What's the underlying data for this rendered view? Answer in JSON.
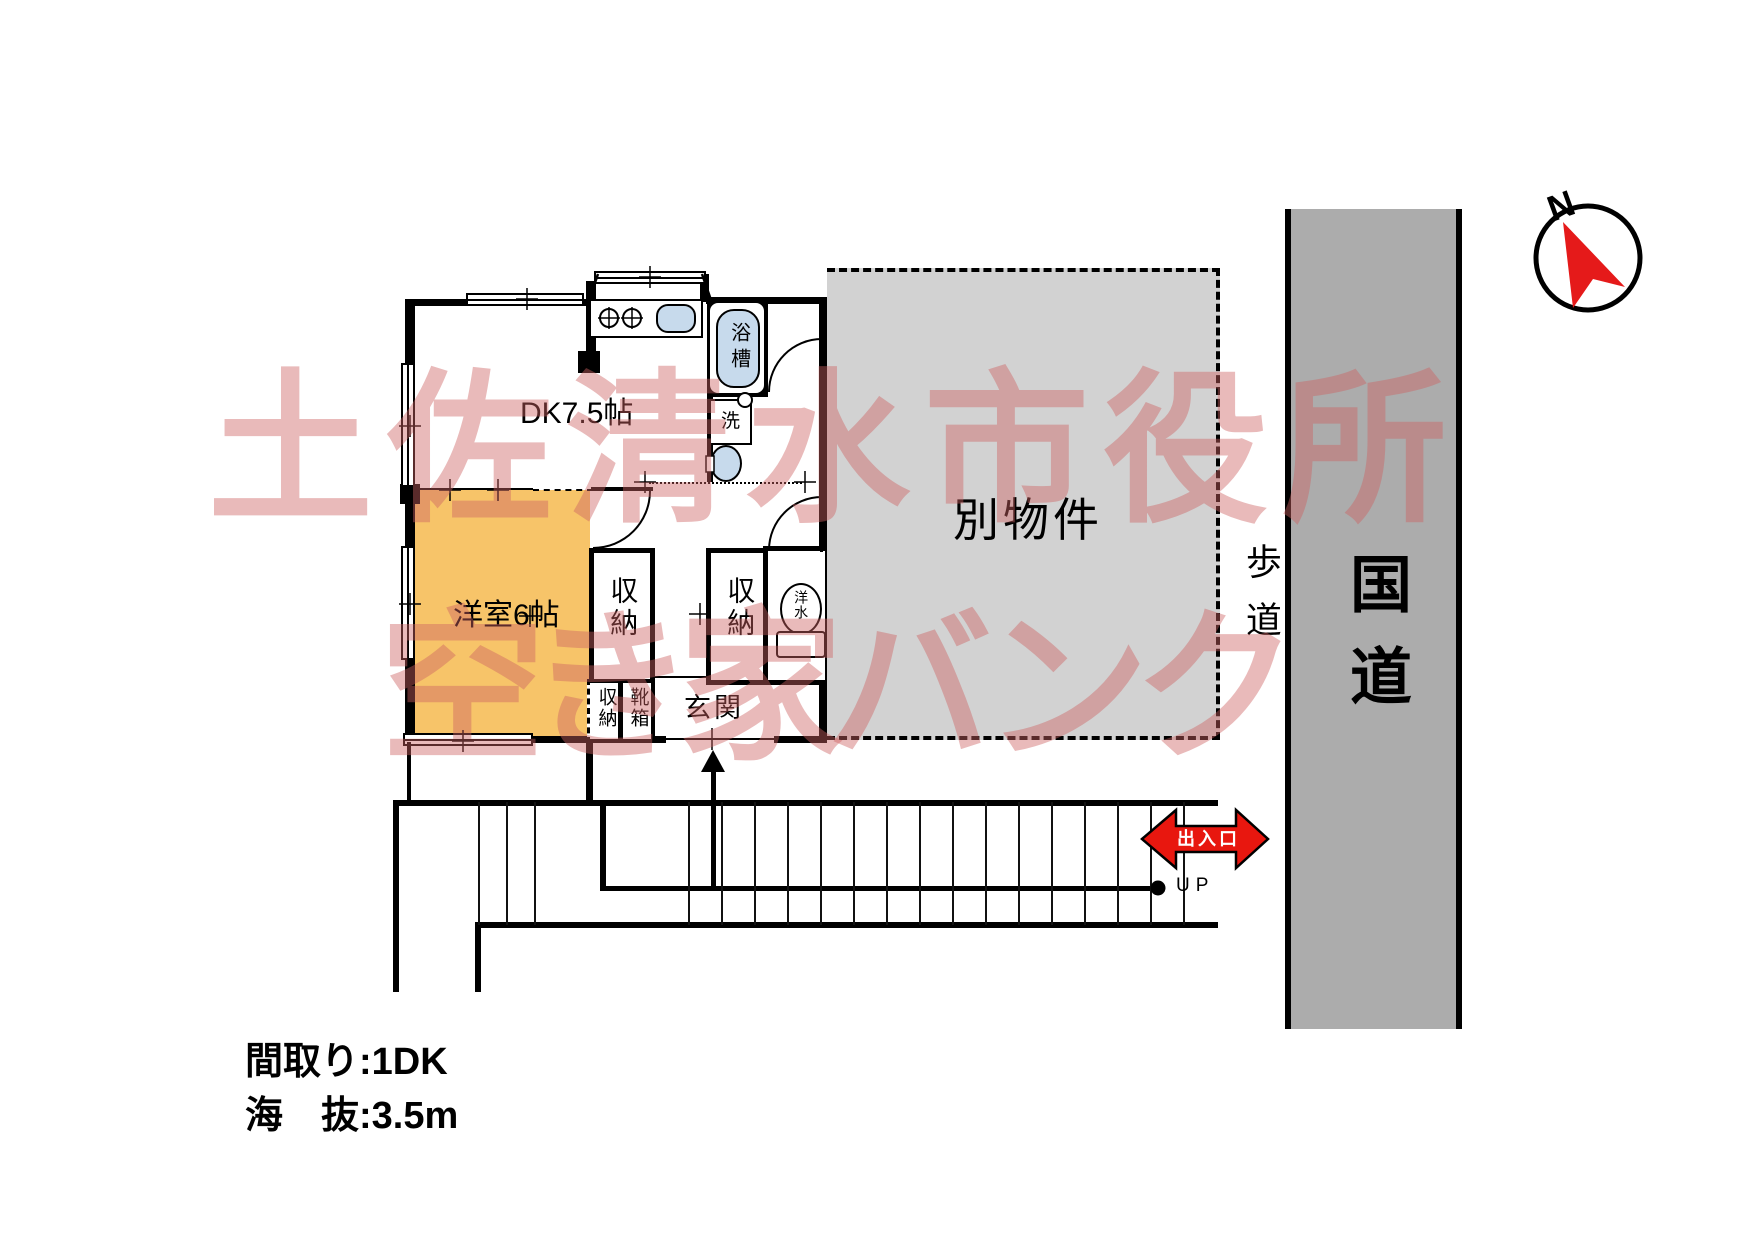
{
  "plan": {
    "dk_label": "DK7.5帖",
    "western_room_label": "洋室6帖",
    "closet_label": "収納",
    "shoe_box_label": "靴箱",
    "entrance_label": "玄関",
    "bathtub_label": "浴槽",
    "washer_label": "洗",
    "toilet_label": "洋水"
  },
  "site": {
    "other_property_label": "別物件",
    "sidewalk_label": "歩道",
    "road_label": "国道",
    "exit_label": "出入口",
    "up_label": "UP",
    "north_label": "N"
  },
  "watermark": {
    "line1": "土佐清水市役所",
    "line2": "空き家バンク"
  },
  "footer": {
    "layout": "間取り:1DK",
    "elevation": "海　抜:3.5m"
  },
  "colors": {
    "room_fill": "#F7C469",
    "fixture_fill": "#C7DAEC",
    "other_property_fill": "#D2D2D2",
    "road_fill": "#ACACAC",
    "exit_red": "#E8170F",
    "watermark_pink": "rgba(206,97,97,0.44)"
  }
}
